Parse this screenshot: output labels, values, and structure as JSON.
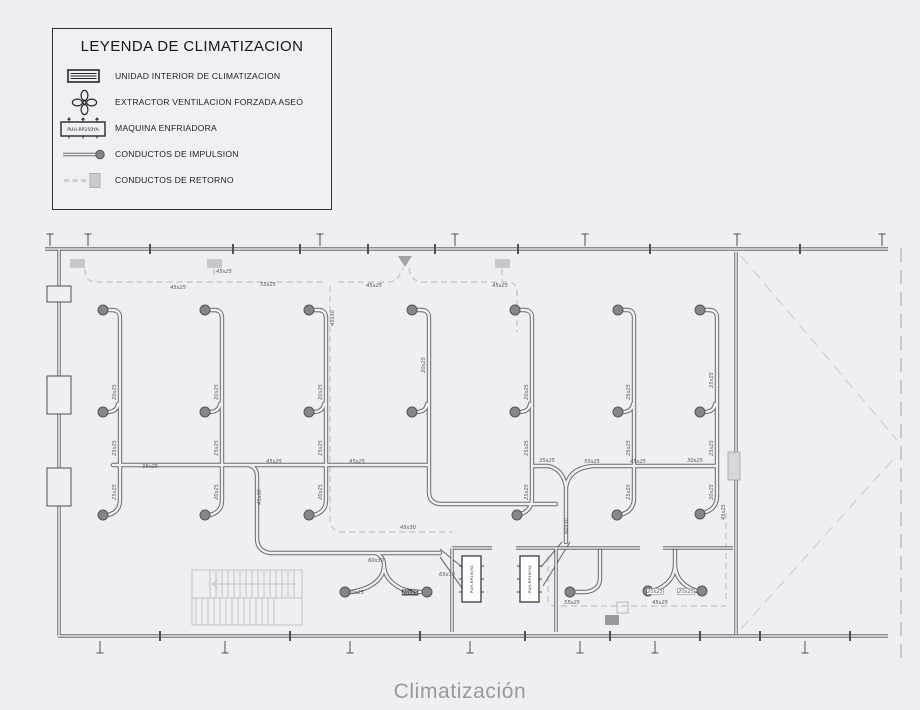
{
  "page": {
    "caption": "Climatización",
    "background": "#edeff3",
    "caption_color": "#98989e"
  },
  "legend": {
    "title": "LEYENDA DE CLIMATIZACION",
    "items": [
      {
        "icon": "indoor-unit-icon",
        "label": "UNIDAD INTERIOR DE CLIMATIZACION"
      },
      {
        "icon": "fan-extractor-icon",
        "label": "EXTRACTOR VENTILACION FORZADA ASEO"
      },
      {
        "icon": "chiller-icon",
        "label": "MAQUINA ENFRIADORA",
        "model": "PUH-RP250YA"
      },
      {
        "icon": "supply-duct-icon",
        "label": "CONDUCTOS DE IMPULSION"
      },
      {
        "icon": "return-duct-icon",
        "label": "CONDUCTOS DE RETORNO"
      }
    ]
  },
  "plan": {
    "colors": {
      "wall": "#4e4e54",
      "supply_duct": "#6a6a71",
      "return_duct": "#c6c6cc",
      "diffuser": "#85858c"
    },
    "machines": [
      {
        "x": 462,
        "y": 556,
        "w": 19,
        "h": 46,
        "label": "PUH-RP250YA"
      },
      {
        "x": 520,
        "y": 556,
        "w": 19,
        "h": 46,
        "label": "PUH-RP250YA"
      }
    ],
    "diffusers": [
      {
        "x": 103,
        "y": 310
      },
      {
        "x": 205,
        "y": 310
      },
      {
        "x": 309,
        "y": 310
      },
      {
        "x": 412,
        "y": 310
      },
      {
        "x": 515,
        "y": 310
      },
      {
        "x": 618,
        "y": 310
      },
      {
        "x": 700,
        "y": 310
      },
      {
        "x": 103,
        "y": 412
      },
      {
        "x": 205,
        "y": 412
      },
      {
        "x": 309,
        "y": 412
      },
      {
        "x": 412,
        "y": 412
      },
      {
        "x": 515,
        "y": 412
      },
      {
        "x": 618,
        "y": 412
      },
      {
        "x": 700,
        "y": 412
      },
      {
        "x": 103,
        "y": 515
      },
      {
        "x": 205,
        "y": 515
      },
      {
        "x": 309,
        "y": 515
      },
      {
        "x": 517,
        "y": 515
      },
      {
        "x": 617,
        "y": 515
      },
      {
        "x": 700,
        "y": 514
      },
      {
        "x": 345,
        "y": 592
      },
      {
        "x": 427,
        "y": 592
      },
      {
        "x": 570,
        "y": 592
      },
      {
        "x": 648,
        "y": 591
      },
      {
        "x": 702,
        "y": 591
      }
    ],
    "duct_labels": [
      {
        "t": "45x25",
        "x": 178,
        "y": 289,
        "r": 0
      },
      {
        "t": "55x25",
        "x": 268,
        "y": 286,
        "r": 0
      },
      {
        "t": "45x25",
        "x": 224,
        "y": 273,
        "r": 0
      },
      {
        "t": "45x25",
        "x": 374,
        "y": 287,
        "r": 0
      },
      {
        "t": "45x25",
        "x": 500,
        "y": 287,
        "r": 0
      },
      {
        "t": "45x30",
        "x": 334,
        "y": 318,
        "r": -90
      },
      {
        "t": "20x25",
        "x": 116,
        "y": 392,
        "r": -90
      },
      {
        "t": "20x25",
        "x": 218,
        "y": 392,
        "r": -90
      },
      {
        "t": "20x25",
        "x": 322,
        "y": 392,
        "r": -90
      },
      {
        "t": "20x25",
        "x": 425,
        "y": 365,
        "r": -90
      },
      {
        "t": "20x25",
        "x": 528,
        "y": 392,
        "r": -90
      },
      {
        "t": "25x25",
        "x": 630,
        "y": 392,
        "r": -90
      },
      {
        "t": "25x25",
        "x": 713,
        "y": 380,
        "r": -90
      },
      {
        "t": "25x25",
        "x": 116,
        "y": 448,
        "r": -90
      },
      {
        "t": "25x25",
        "x": 218,
        "y": 448,
        "r": -90
      },
      {
        "t": "25x25",
        "x": 322,
        "y": 448,
        "r": -90
      },
      {
        "t": "25x25",
        "x": 528,
        "y": 448,
        "r": -90
      },
      {
        "t": "25x25",
        "x": 630,
        "y": 448,
        "r": -90
      },
      {
        "t": "25x25",
        "x": 713,
        "y": 448,
        "r": -90
      },
      {
        "t": "35x25",
        "x": 150,
        "y": 468,
        "r": 0
      },
      {
        "t": "45x25",
        "x": 274,
        "y": 463,
        "r": 0
      },
      {
        "t": "45x25",
        "x": 357,
        "y": 463,
        "r": 0
      },
      {
        "t": "35x25",
        "x": 547,
        "y": 462,
        "r": 0
      },
      {
        "t": "55x25",
        "x": 592,
        "y": 463,
        "r": 0
      },
      {
        "t": "45x25",
        "x": 638,
        "y": 463,
        "r": 0
      },
      {
        "t": "30x25",
        "x": 695,
        "y": 462,
        "r": 0
      },
      {
        "t": "25x25",
        "x": 116,
        "y": 492,
        "r": -90
      },
      {
        "t": "20x25",
        "x": 218,
        "y": 492,
        "r": -90
      },
      {
        "t": "20x25",
        "x": 322,
        "y": 492,
        "r": -90
      },
      {
        "t": "25x25",
        "x": 528,
        "y": 492,
        "r": -90
      },
      {
        "t": "25x25",
        "x": 630,
        "y": 492,
        "r": -90
      },
      {
        "t": "20x25",
        "x": 713,
        "y": 492,
        "r": -90
      },
      {
        "t": "45x30",
        "x": 261,
        "y": 497,
        "r": -90
      },
      {
        "t": "60x30",
        "x": 568,
        "y": 526,
        "r": -90
      },
      {
        "t": "60x30",
        "x": 376,
        "y": 562,
        "r": 0
      },
      {
        "t": "65x30",
        "x": 447,
        "y": 576,
        "r": 0
      },
      {
        "t": "45x30",
        "x": 408,
        "y": 529,
        "r": 0
      },
      {
        "t": "20x25",
        "x": 356,
        "y": 594,
        "r": 0
      },
      {
        "t": "20x25",
        "x": 410,
        "y": 594,
        "r": 0,
        "inv": 1
      },
      {
        "t": "20x25",
        "x": 655,
        "y": 593,
        "r": 0,
        "box": 1
      },
      {
        "t": "20x25",
        "x": 686,
        "y": 593,
        "r": 0,
        "box": 1
      },
      {
        "t": "55x25",
        "x": 572,
        "y": 604,
        "r": 0
      },
      {
        "t": "45x25",
        "x": 660,
        "y": 604,
        "r": 0
      },
      {
        "t": "45x25",
        "x": 725,
        "y": 512,
        "r": -90
      }
    ]
  }
}
